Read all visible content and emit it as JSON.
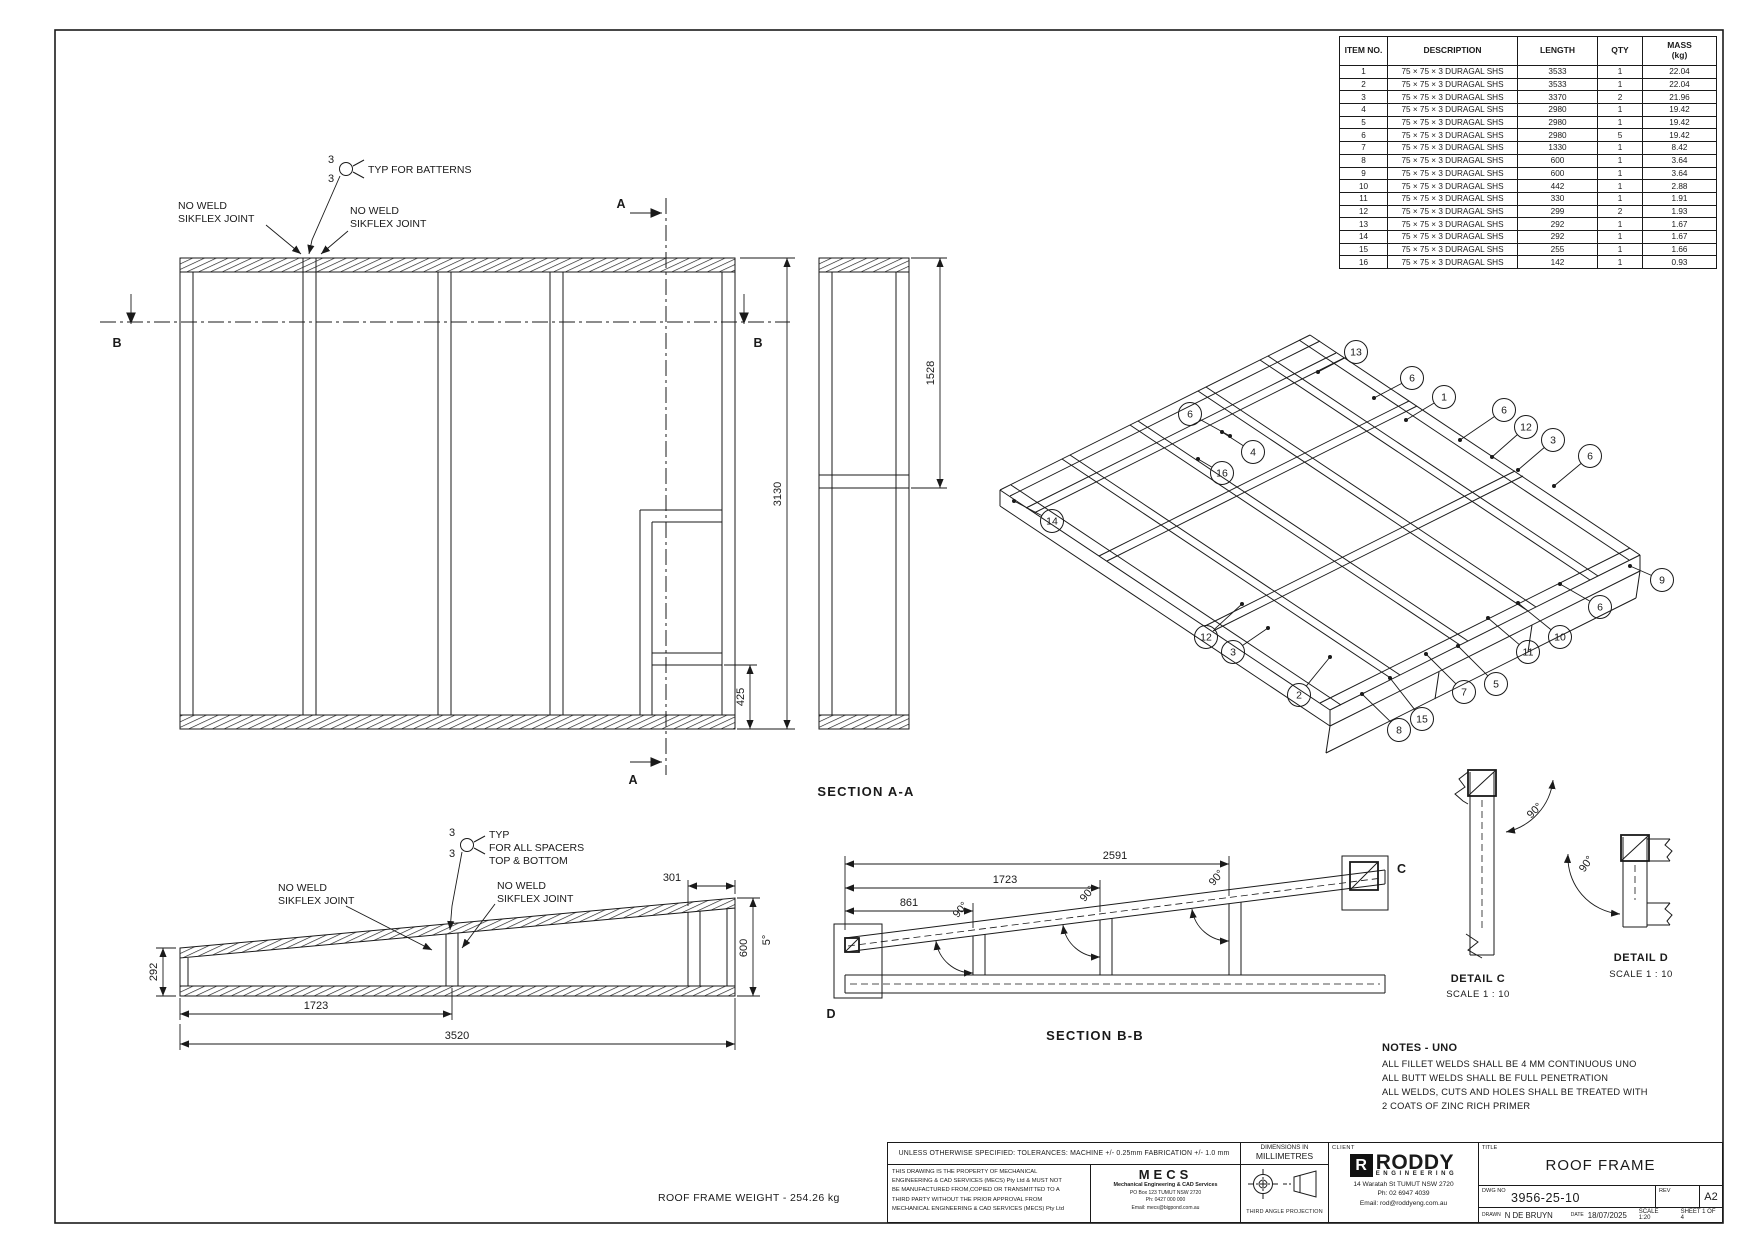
{
  "colors": {
    "line": "#1a1a1a",
    "bg": "#ffffff"
  },
  "bom": {
    "headers": [
      "ITEM NO.",
      "DESCRIPTION",
      "LENGTH",
      "QTY",
      "MASS\n(kg)"
    ],
    "rows": [
      [
        "1",
        "75 × 75 × 3 DURAGAL SHS",
        "3533",
        "1",
        "22.04"
      ],
      [
        "2",
        "75 × 75 × 3 DURAGAL SHS",
        "3533",
        "1",
        "22.04"
      ],
      [
        "3",
        "75 × 75 × 3 DURAGAL SHS",
        "3370",
        "2",
        "21.96"
      ],
      [
        "4",
        "75 × 75 × 3 DURAGAL SHS",
        "2980",
        "1",
        "19.42"
      ],
      [
        "5",
        "75 × 75 × 3 DURAGAL SHS",
        "2980",
        "1",
        "19.42"
      ],
      [
        "6",
        "75 × 75 × 3 DURAGAL SHS",
        "2980",
        "5",
        "19.42"
      ],
      [
        "7",
        "75 × 75 × 3 DURAGAL SHS",
        "1330",
        "1",
        "8.42"
      ],
      [
        "8",
        "75 × 75 × 3 DURAGAL SHS",
        "600",
        "1",
        "3.64"
      ],
      [
        "9",
        "75 × 75 × 3 DURAGAL SHS",
        "600",
        "1",
        "3.64"
      ],
      [
        "10",
        "75 × 75 × 3 DURAGAL SHS",
        "442",
        "1",
        "2.88"
      ],
      [
        "11",
        "75 × 75 × 3 DURAGAL SHS",
        "330",
        "1",
        "1.91"
      ],
      [
        "12",
        "75 × 75 × 3 DURAGAL SHS",
        "299",
        "2",
        "1.93"
      ],
      [
        "13",
        "75 × 75 × 3 DURAGAL SHS",
        "292",
        "1",
        "1.67"
      ],
      [
        "14",
        "75 × 75 × 3 DURAGAL SHS",
        "292",
        "1",
        "1.67"
      ],
      [
        "15",
        "75 × 75 × 3 DURAGAL SHS",
        "255",
        "1",
        "1.66"
      ],
      [
        "16",
        "75 × 75 × 3 DURAGAL SHS",
        "142",
        "1",
        "0.93"
      ]
    ]
  },
  "front_view": {
    "weld_size": "3",
    "typ_batterns": "TYP FOR BATTERNS",
    "no_weld_line1": "NO WELD",
    "no_weld_line2": "SIKFLEX JOINT",
    "dim_height": "3130",
    "dim_opening": "425",
    "mark_a": "A",
    "mark_b": "B"
  },
  "section_aa": {
    "title": "SECTION A-A",
    "dim_top": "1528"
  },
  "profile_view": {
    "weld_size": "3",
    "spacer_note_1": "TYP",
    "spacer_note_2": "FOR ALL SPACERS",
    "spacer_note_3": "TOP & BOTTOM",
    "no_weld_line1": "NO WELD",
    "no_weld_line2": "SIKFLEX JOINT",
    "dim_left": "292",
    "dim_span": "1723",
    "dim_total": "3520",
    "dim_top_right": "301",
    "dim_right": "600",
    "dim_angle": "5°"
  },
  "section_bb": {
    "title": "SECTION B-B",
    "dim_1": "861",
    "dim_2": "1723",
    "dim_3": "2591",
    "angle": "90°",
    "mark_c": "C",
    "mark_d": "D"
  },
  "detail_c": {
    "title": "DETAIL C",
    "scale": "SCALE 1 : 10",
    "angle": "90°"
  },
  "detail_d": {
    "title": "DETAIL D",
    "scale": "SCALE 1 : 10",
    "angle": "90°"
  },
  "iso_view": {
    "balloons": [
      "13",
      "6",
      "1",
      "6",
      "12",
      "3",
      "6",
      "6",
      "4",
      "16",
      "14",
      "9",
      "6",
      "10",
      "11",
      "5",
      "7",
      "15",
      "8",
      "2",
      "3",
      "12"
    ]
  },
  "notes": {
    "title": "NOTES - UNO",
    "lines": [
      "ALL FILLET WELDS SHALL BE 4 MM CONTINUOUS UNO",
      "ALL BUTT WELDS SHALL BE FULL PENETRATION",
      "ALL WELDS, CUTS AND HOLES SHALL BE TREATED WITH",
      "2 COATS OF ZINC RICH PRIMER"
    ]
  },
  "weight_note": "ROOF FRAME WEIGHT - 254.26 kg",
  "title_block": {
    "tolerances": "UNLESS OTHERWISE SPECIFIED: TOLERANCES: MACHINE +/- 0.25mm   FABRICATION +/- 1.0 mm",
    "dims_note_1": "DIMENSIONS IN",
    "dims_note_2": "MILLIMETRES",
    "property_lines": [
      "THIS DRAWING IS THE PROPERTY OF MECHANICAL",
      "ENGINEERING & CAD SERVICES (MECS) Pty Ltd & MUST NOT",
      "BE MANUFACTURED FROM,COPIED OR TRANSMITTED TO A",
      "THIRD PARTY WITHOUT THE PRIOR APPROVAL FROM",
      "MECHANICAL ENGINEERING & CAD SERVICES (MECS) Pty Ltd"
    ],
    "mecs_name": "MECS",
    "mecs_lines": [
      "Mechanical Engineering & CAD Services",
      "PO Box 123 TUMUT NSW 2720",
      "Ph: 0427 000 000",
      "Email: mecs@bigpond.com.au"
    ],
    "projection": "THIRD ANGLE PROJECTION",
    "client_label": "CLIENT",
    "logo_r": "R",
    "logo_name": "RODDY",
    "logo_sub": "ENGINEERING",
    "client_lines": [
      "14 Waratah St TUMUT NSW 2720",
      "Ph: 02 6947 4039",
      "Email: rod@roddyeng.com.au"
    ],
    "title_label": "TITLE",
    "title": "ROOF FRAME",
    "dwg_label": "DWG NO",
    "dwg_no": "3956-25-10",
    "rev_label": "REV",
    "size": "A2",
    "drawn_label": "DRAWN",
    "drawn": "N DE BRUYN",
    "date_label": "DATE",
    "date": "18/07/2025",
    "scale": "SCALE 1:20",
    "sheet": "SHEET 1 OF 4"
  }
}
